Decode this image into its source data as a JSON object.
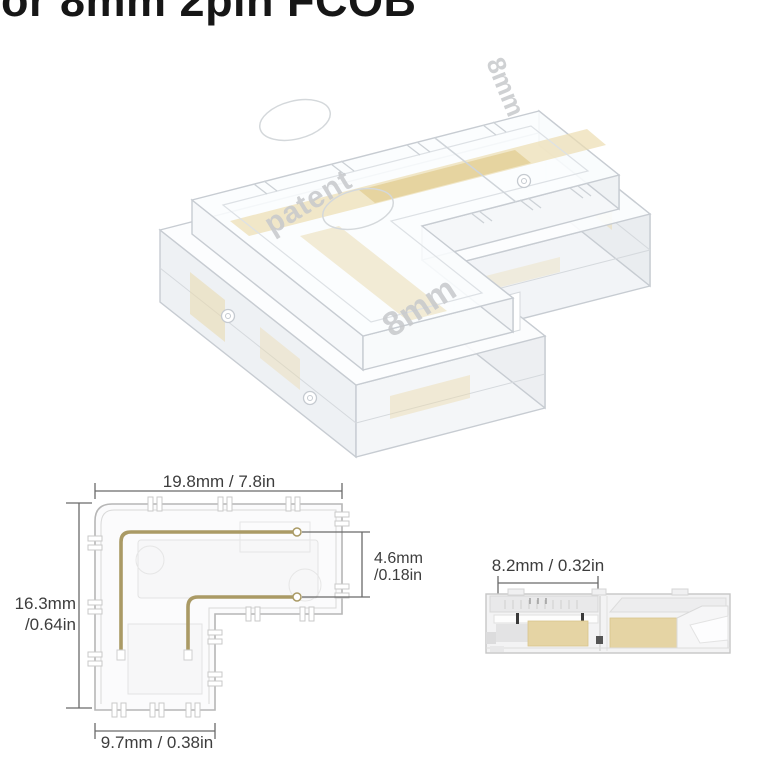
{
  "title": {
    "text": "For 8mm 2pin FCOB"
  },
  "product": {
    "description": "Transparent L-shape corner connector for 8mm 2pin FCOB LED strip",
    "embossed": {
      "patent": "patent",
      "size_top": "8mm",
      "size_arm": "8mm"
    },
    "colors": {
      "body_edge": "#c7ccd2",
      "contact_strip": "#ead9ab"
    }
  },
  "top_view": {
    "dim_width": "19.8mm / 7.8in",
    "dim_height": [
      "16.3mm",
      "/0.64in"
    ],
    "dim_pin_gap": [
      "4.6mm",
      "/0.18in"
    ],
    "dim_arm": "9.7mm / 0.38in",
    "colors": {
      "pin": "#aa9a65",
      "outline": "#b6b6b6",
      "dim_line": "#6a6a6a",
      "dim_text": "#3d3d3d"
    }
  },
  "side_view": {
    "dim_clamp": "8.2mm / 0.32in",
    "colors": {
      "strip_block": "#e5d4a4",
      "outline": "#c6c6c6"
    }
  }
}
